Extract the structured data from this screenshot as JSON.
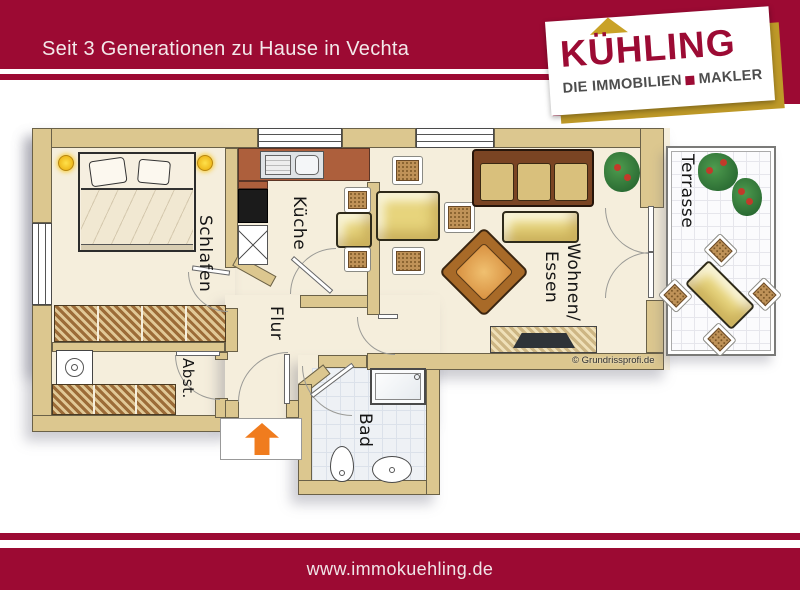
{
  "header": {
    "tagline": "Seit 3 Generationen zu Hause in Vechta"
  },
  "logo": {
    "brand": "KÜHLING",
    "sub_prefix": "DIE IMMOBILIEN",
    "sub_suffix": "MAKLER"
  },
  "plan": {
    "rooms": {
      "schlafen": "Schlafen",
      "kueche": "Küche",
      "flur": "Flur",
      "abst": "Abst.",
      "bad": "Bad",
      "wohnen_line1": "Wohnen/",
      "wohnen_line2": "Essen",
      "terrasse": "Terrasse"
    },
    "copyright": "© Grundrissprofi.de",
    "icons": [
      "bed",
      "pillow",
      "lamp",
      "wardrobe",
      "washing-machine",
      "shelf",
      "stove",
      "kitchen-sink",
      "fridge-x",
      "dining-table",
      "wicker-chair",
      "sofa",
      "coffee-table",
      "armchair",
      "tv-sideboard",
      "plant",
      "shower",
      "toilet",
      "washbasin",
      "entrance-arrow",
      "door-arc",
      "window"
    ]
  },
  "footer": {
    "url": "www.immokuehling.de"
  },
  "colors": {
    "brand_red": "#9C0A33",
    "gold": "#BE9928",
    "wall_tan": "#DCC78F",
    "terracotta": "#AD5F3C",
    "furniture_yellow": "#E7D47C",
    "arrow_orange": "#F07C1E"
  }
}
